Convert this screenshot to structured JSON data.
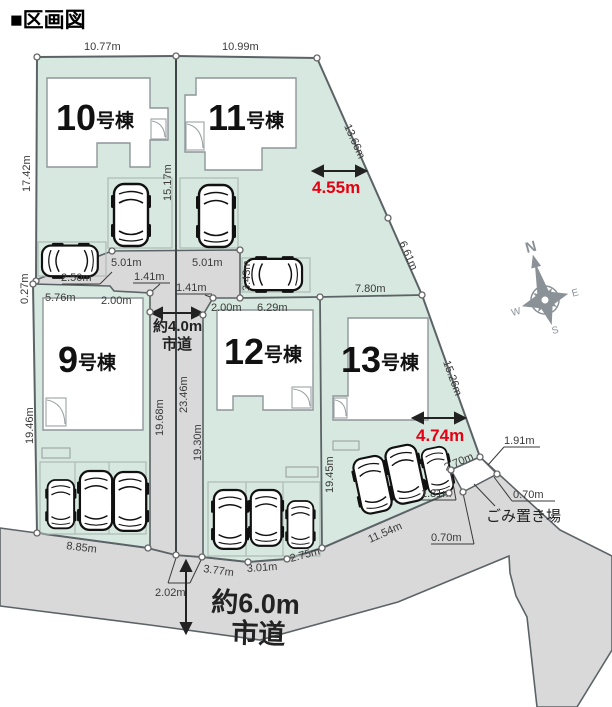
{
  "title": "■区画図",
  "colors": {
    "parcel_green": "#d6e8df",
    "road_gray": "#d9d9d9",
    "outline": "#5c6366",
    "red": "#e60012"
  },
  "lots": [
    {
      "num": "10",
      "suffix": "号棟"
    },
    {
      "num": "11",
      "suffix": "号棟"
    },
    {
      "num": "9",
      "suffix": "号棟"
    },
    {
      "num": "12",
      "suffix": "号棟"
    },
    {
      "num": "13",
      "suffix": "号棟"
    }
  ],
  "roads": {
    "road4_line1": "約4.0m",
    "road4_line2": "市道",
    "road6_line1": "約6.0m",
    "road6_line2": "市道"
  },
  "garbage_label": "ごみ置き場",
  "compass": {
    "n": "N",
    "e": "E",
    "s": "S",
    "w": "W"
  },
  "measurements": {
    "top_left": "10.77m",
    "top_right": "10.99m",
    "left_lot10": "17.42m",
    "mid_divider": "15.17m",
    "diag_1": "13.66m",
    "diag_2": "6.61m",
    "diag_3": "15.26m",
    "red_top": "4.55m",
    "red_bottom": "4.74m",
    "jog_left": "0.27m",
    "bay_left": "2.50m",
    "head_left_w": "5.01m",
    "head_left_jog": "1.41m",
    "head_right_w": "5.01m",
    "head_right_jog": "1.41m",
    "head_right_h": "3.43m",
    "lot9_top": "5.76m",
    "lot9_top_step": "2.00m",
    "lot12_top_step": "2.00m",
    "lot12_top": "6.29m",
    "lot13_top": "7.80m",
    "left_lot9": "19.46m",
    "road_left": "19.68m",
    "road_center": "23.46m",
    "road_right": "19.30m",
    "lot13_left": "19.45m",
    "lot9_bottom": "8.85m",
    "road_bottom": "2.02m",
    "lot12_b1": "3.77m",
    "lot12_b2": "3.01m",
    "lot12_b3": "2.75m",
    "lot13_bottom": "11.54m",
    "gb_topleft": "2.70m",
    "gb_topright": "1.91m",
    "gb_right": "0.70m",
    "gb_left": "1.81m",
    "gb_bottom": "0.70m"
  }
}
